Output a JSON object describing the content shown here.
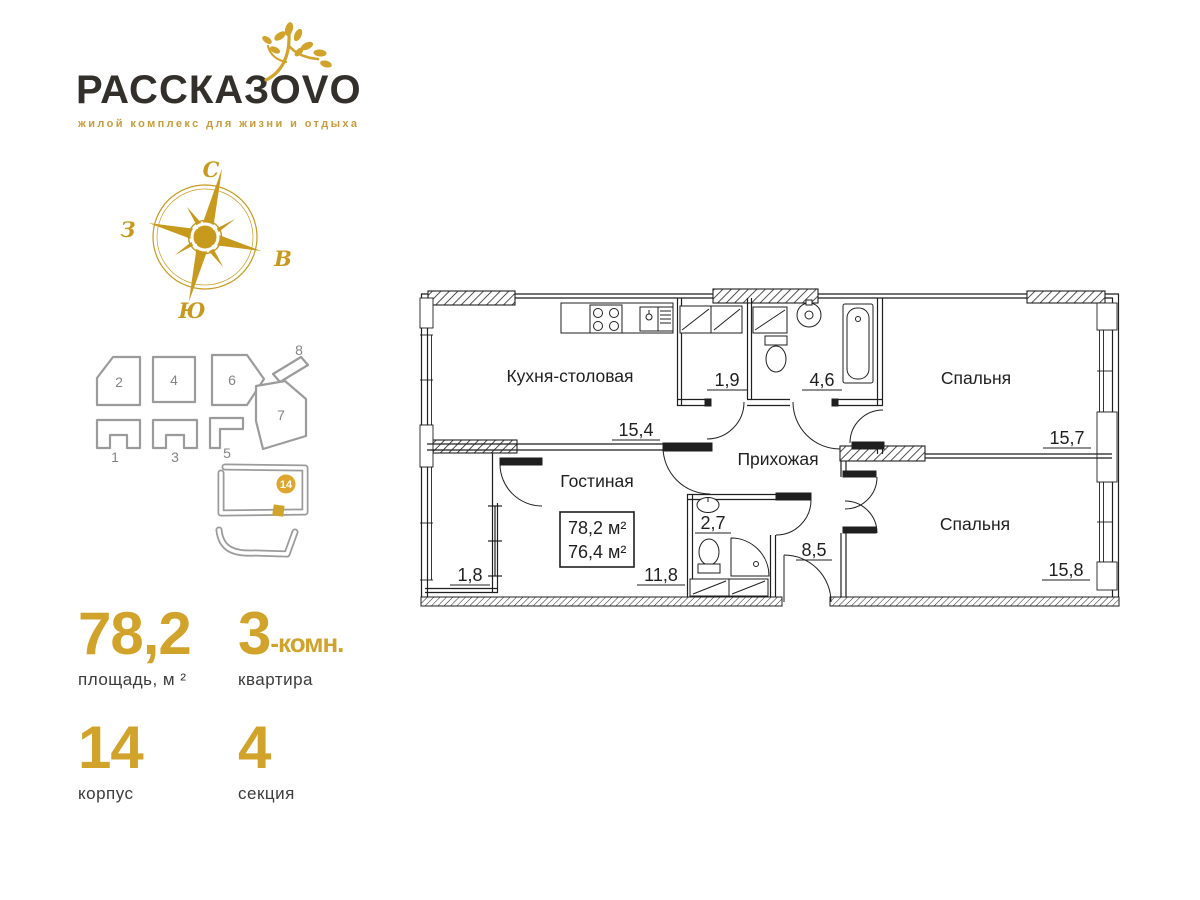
{
  "brand": {
    "logo_text": "РАССКАЗОVO",
    "tagline": "жилой комплекс для жизни и отдыха"
  },
  "colors": {
    "gold": "#d2a32b",
    "dark_text": "#3b3b3b",
    "plan_line": "#1f1f1f",
    "site_gray": "#9b9b9b"
  },
  "compass": {
    "north": "С",
    "south": "Ю",
    "west": "З",
    "east": "В"
  },
  "site_plan": {
    "numbers": [
      "1",
      "2",
      "3",
      "4",
      "5",
      "6",
      "7",
      "8"
    ],
    "highlight_building": "14"
  },
  "stats": {
    "area": {
      "value": "78,2",
      "label": "площадь, м ²"
    },
    "rooms": {
      "value": "3",
      "suffix": "-комн.",
      "label": "квартира"
    },
    "building": {
      "value": "14",
      "label": "корпус"
    },
    "section": {
      "value": "4",
      "label": "секция"
    }
  },
  "floor_plan": {
    "rooms": {
      "kitchen": {
        "name": "Кухня-столовая",
        "area": "15,4"
      },
      "living": {
        "name": "Гостиная",
        "area": "11,8"
      },
      "hallway": {
        "name": "Прихожая",
        "area": "8,5"
      },
      "bedroom_top": {
        "name": "Спальня",
        "area": "15,7"
      },
      "bedroom_bottom": {
        "name": "Спальня",
        "area": "15,8"
      },
      "wardrobe": {
        "area": "1,9"
      },
      "bathroom": {
        "area": "4,6"
      },
      "wc": {
        "area": "2,7"
      },
      "balcony": {
        "area": "1,8"
      }
    },
    "area_box": {
      "total": "78,2 м²",
      "living": "76,4 м²"
    }
  }
}
